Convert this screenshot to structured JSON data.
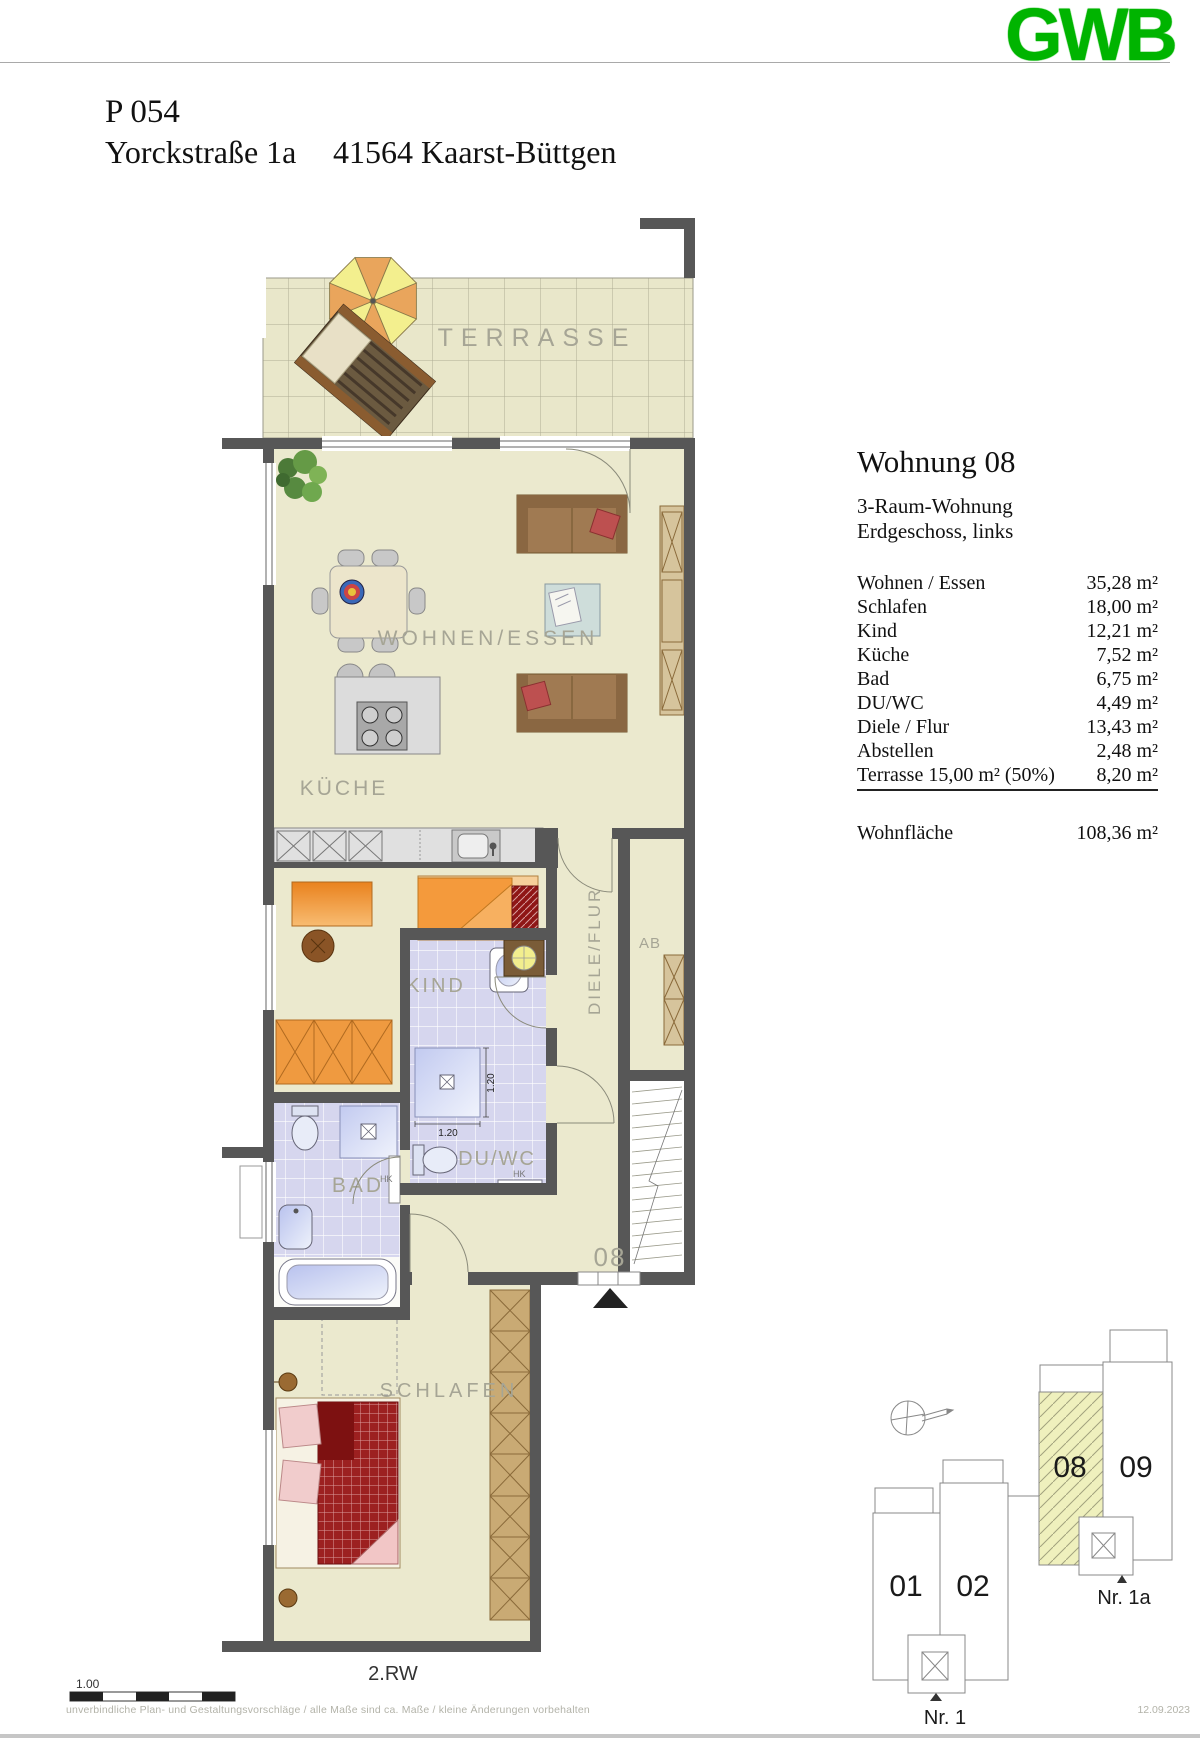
{
  "colors": {
    "logo_green": "#00b400",
    "wall_gray": "#575757",
    "floor_cream": "#ebe9ce",
    "bath_tile": "#d6d6ee",
    "site_highlight": "#eff0bd",
    "furniture_orange": "#f09a40"
  },
  "header": {
    "logo": "GWB",
    "project": "P 054",
    "street": "Yorckstraße 1a",
    "city": "41564 Kaarst-Büttgen"
  },
  "info_panel": {
    "title": "Wohnung 08",
    "apartment_type": "3-Raum-Wohnung",
    "floor_location": "Erdgeschoss, links",
    "rooms": [
      {
        "label": "Wohnen / Essen",
        "area": "35,28 m²"
      },
      {
        "label": "Schlafen",
        "area": "18,00 m²"
      },
      {
        "label": "Kind",
        "area": "12,21 m²"
      },
      {
        "label": "Küche",
        "area": "7,52 m²"
      },
      {
        "label": "Bad",
        "area": "6,75 m²"
      },
      {
        "label": "DU/WC",
        "area": "4,49 m²"
      },
      {
        "label": "Diele / Flur",
        "area": "13,43 m²"
      },
      {
        "label": "Abstellen",
        "area": "2,48 m²"
      },
      {
        "label": "Terrasse 15,00 m² (50%)",
        "area": "8,20 m²"
      }
    ],
    "total_label": "Wohnfläche",
    "total_area": "108,36 m²"
  },
  "plan": {
    "labels": {
      "terrace": "TERRASSE",
      "living": "WOHNEN/ESSEN",
      "kitchen": "KÜCHE",
      "child": "KIND",
      "hallway": "DIELE/FLUR",
      "storage": "AB",
      "bath": "BAD",
      "shower_wc": "DU/WC",
      "bedroom": "SCHLAFEN"
    },
    "entry_number": "08",
    "radiator_bath": "HK",
    "radiator_shower_wc": "HK",
    "dim_shower_width": "1.20",
    "dim_shower_depth": "1.20",
    "scale_value": "1.00",
    "drainage_label": "2.RW"
  },
  "site_plan": {
    "building_01": "01",
    "building_02": "02",
    "building_08": "08",
    "building_09": "09",
    "entrance_1": "Nr. 1",
    "entrance_1a": "Nr. 1a"
  },
  "footer": {
    "disclaimer": "unverbindliche Plan- und Gestaltungsvorschläge / alle Maße sind ca. Maße / kleine Änderungen vorbehalten",
    "date": "12.09.2023"
  }
}
